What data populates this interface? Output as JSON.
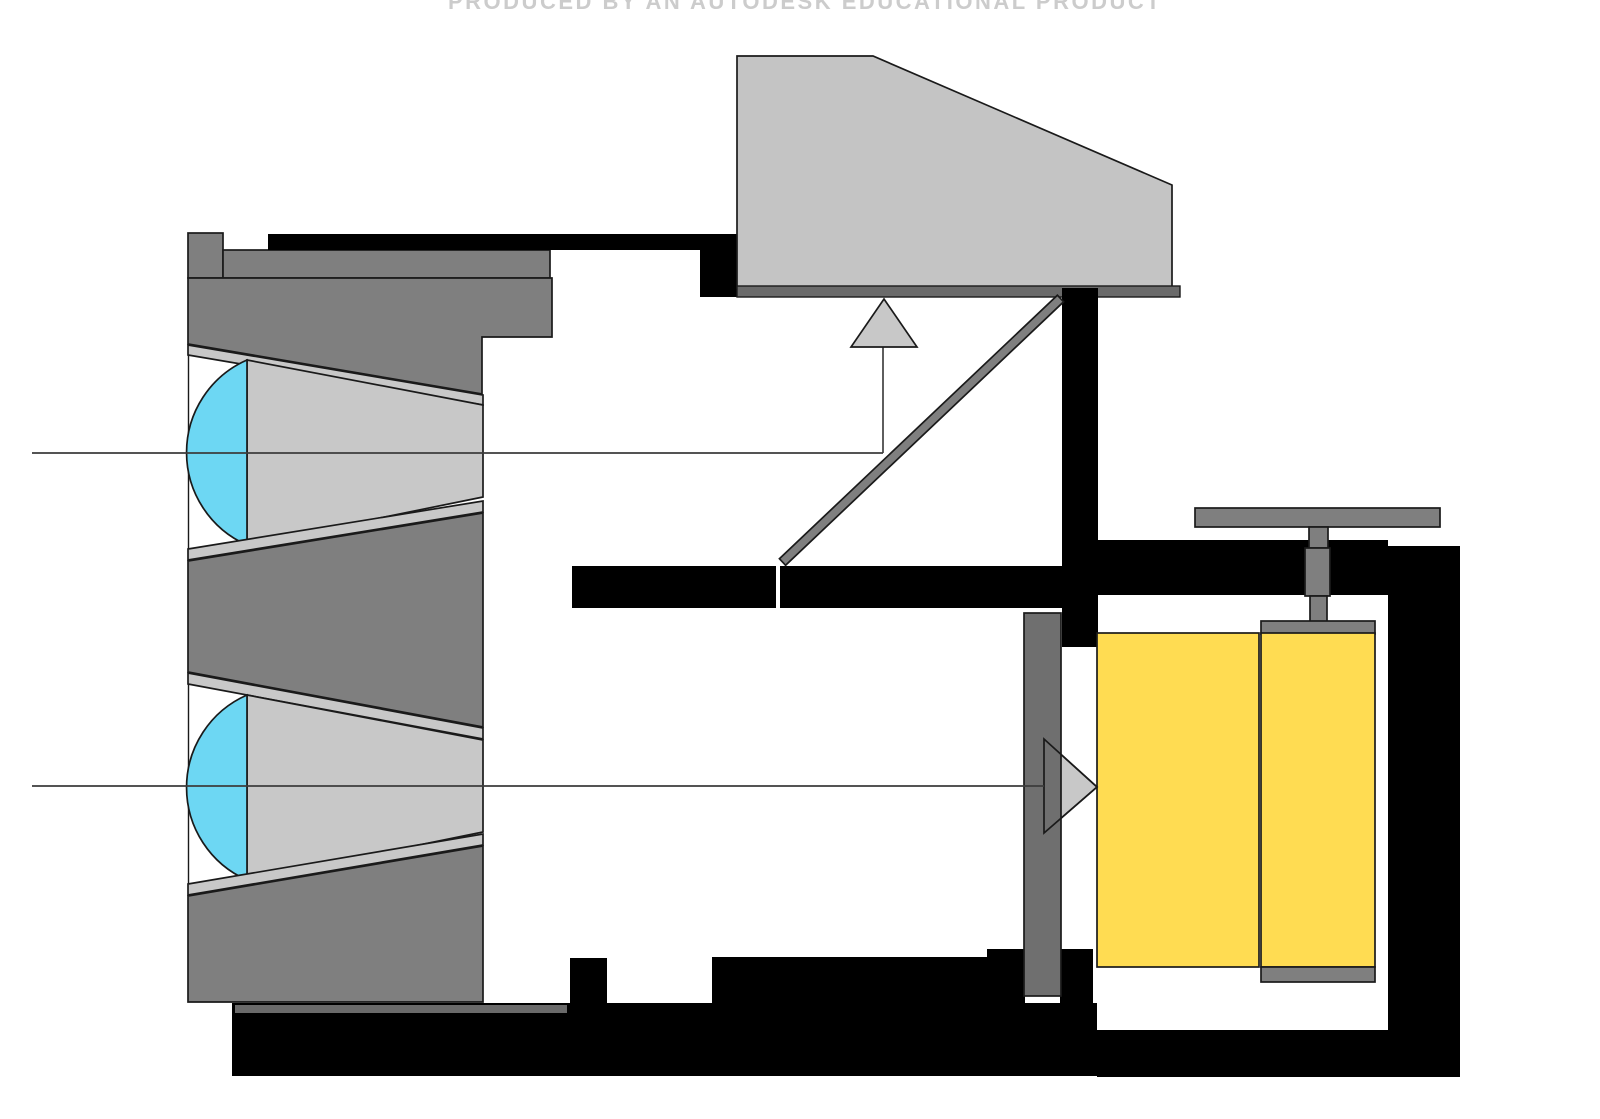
{
  "watermark": {
    "text": "PRODUCED BY AN AUTODESK EDUCATIONAL PRODUCT"
  },
  "diagram": {
    "type": "technical-cross-section",
    "subject": "single-lens-reflex camera light path"
  },
  "parts": {
    "lens_elements": "front and rear lens elements",
    "light_cones": "converging light beams",
    "reflex_mirror": "reflex mirror",
    "viewfinder_prism": "viewfinder prism housing",
    "focusing_screen": "focusing screen",
    "shutter_curtain": "shutter curtain",
    "film_cartridge": "film cartridge",
    "takeup_spool": "take-up spool",
    "film_advance_crank": "film advance crank",
    "optical_axes": "optical axis rays",
    "camera_body": "camera body frame"
  },
  "colors": {
    "background": "#ffffff",
    "black": "#000000",
    "dark_gray": "#7f7f7f",
    "mid_gray": "#6f6f6f",
    "screen_gray": "#6a6a6a",
    "light_gray": "#c8c8c8",
    "prism_gray": "#c4c4c4",
    "lens_blue": "#6dd7f3",
    "film_yellow": "#ffdc52",
    "axis_line": "#3c3c3c",
    "watermark_gray": "#cccccc"
  }
}
